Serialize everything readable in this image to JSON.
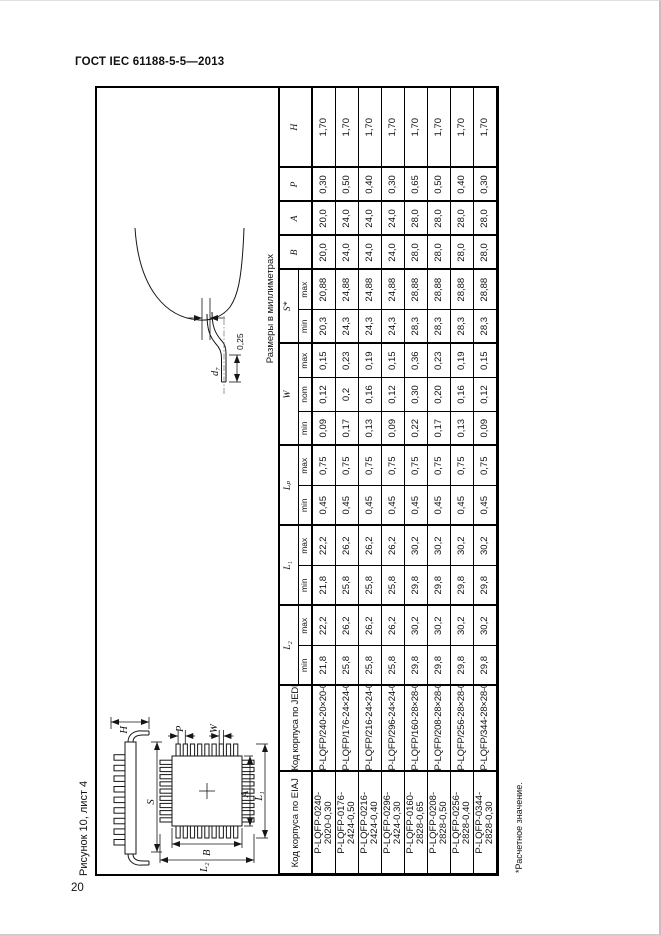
{
  "page": {
    "doc_header": "ГОСТ IEC 61188-5-5—2013",
    "page_number": "20",
    "figure_caption": "Рисунок 10, лист 4",
    "units_note": "Размеры в миллиметрах",
    "footnote": "*Расчетное значение."
  },
  "figure": {
    "labels": {
      "h": "H",
      "s": "S",
      "p": "P",
      "w": "W",
      "a": "A",
      "l1": "L₁",
      "b": "B",
      "l2": "L₂",
      "d7": "d₇",
      "gauge": "0,25"
    }
  },
  "table": {
    "headers": {
      "eiaj": "Код корпуса по EIAJ",
      "jedec": "Код корпуса по JEDEC",
      "l2": "L₂",
      "l1": "L₁",
      "lp": "Lₚ",
      "w": "W",
      "s": "S*",
      "b": "B",
      "a": "A",
      "p": "P",
      "h": "H",
      "min": "min",
      "max": "max",
      "nom": "nom"
    },
    "rows": [
      {
        "eiaj1": "P-LQFP-0240-",
        "eiaj2": "2020-0,30",
        "jedec": "P-LQFP/240-20×20-0,30",
        "l2_min": "21,8",
        "l2_max": "22,2",
        "l1_min": "21,8",
        "l1_max": "22,2",
        "lp_min": "0,45",
        "lp_max": "0,75",
        "w_min": "0,09",
        "w_nom": "0,12",
        "w_max": "0,15",
        "s_min": "20,3",
        "s_max": "20,88",
        "b": "20,0",
        "a": "20,0",
        "p": "0,30",
        "h": "1,70"
      },
      {
        "eiaj1": "P-LQFP-0176-",
        "eiaj2": "2424-0,50",
        "jedec": "P-LQFP/176-24×24-0,50",
        "l2_min": "25,8",
        "l2_max": "26,2",
        "l1_min": "25,8",
        "l1_max": "26,2",
        "lp_min": "0,45",
        "lp_max": "0,75",
        "w_min": "0,17",
        "w_nom": "0,2",
        "w_max": "0,23",
        "s_min": "24,3",
        "s_max": "24,88",
        "b": "24,0",
        "a": "24,0",
        "p": "0,50",
        "h": "1,70"
      },
      {
        "eiaj1": "P-LQFP-0216-",
        "eiaj2": "2424-0,40",
        "jedec": "P-LQFP/216-24×24-0,40",
        "l2_min": "25,8",
        "l2_max": "26,2",
        "l1_min": "25,8",
        "l1_max": "26,2",
        "lp_min": "0,45",
        "lp_max": "0,75",
        "w_min": "0,13",
        "w_nom": "0,16",
        "w_max": "0,19",
        "s_min": "24,3",
        "s_max": "24,88",
        "b": "24,0",
        "a": "24,0",
        "p": "0,40",
        "h": "1,70"
      },
      {
        "eiaj1": "P-LQFP-0296-",
        "eiaj2": "2424-0,30",
        "jedec": "P-LQFP/296-24×24-0,30",
        "l2_min": "25,8",
        "l2_max": "26,2",
        "l1_min": "25,8",
        "l1_max": "26,2",
        "lp_min": "0,45",
        "lp_max": "0,75",
        "w_min": "0,09",
        "w_nom": "0,12",
        "w_max": "0,15",
        "s_min": "24,3",
        "s_max": "24,88",
        "b": "24,0",
        "a": "24,0",
        "p": "0,30",
        "h": "1,70"
      },
      {
        "eiaj1": "P-LQFP-0160-",
        "eiaj2": "2828-0,65",
        "jedec": "P-LQFP/160-28×28-0,65",
        "l2_min": "29,8",
        "l2_max": "30,2",
        "l1_min": "29,8",
        "l1_max": "30,2",
        "lp_min": "0,45",
        "lp_max": "0,75",
        "w_min": "0,22",
        "w_nom": "0,30",
        "w_max": "0,36",
        "s_min": "28,3",
        "s_max": "28,88",
        "b": "28,0",
        "a": "28,0",
        "p": "0,65",
        "h": "1,70"
      },
      {
        "eiaj1": "P-LQFP-0208-",
        "eiaj2": "2828-0,50",
        "jedec": "P-LQFP/208-28×28-0,50",
        "l2_min": "29,8",
        "l2_max": "30,2",
        "l1_min": "29,8",
        "l1_max": "30,2",
        "lp_min": "0,45",
        "lp_max": "0,75",
        "w_min": "0,17",
        "w_nom": "0,20",
        "w_max": "0,23",
        "s_min": "28,3",
        "s_max": "28,88",
        "b": "28,0",
        "a": "28,0",
        "p": "0,50",
        "h": "1,70"
      },
      {
        "eiaj1": "P-LQFP-0256-",
        "eiaj2": "2828-0,40",
        "jedec": "P-LQFP/256-28×28-0,40",
        "l2_min": "29,8",
        "l2_max": "30,2",
        "l1_min": "29,8",
        "l1_max": "30,2",
        "lp_min": "0,45",
        "lp_max": "0,75",
        "w_min": "0,13",
        "w_nom": "0,16",
        "w_max": "0,19",
        "s_min": "28,3",
        "s_max": "28,88",
        "b": "28,0",
        "a": "28,0",
        "p": "0,40",
        "h": "1,70"
      },
      {
        "eiaj1": "P-LQFP-0344-",
        "eiaj2": "2828-0,30",
        "jedec": "P-LQFP/344-28×28-0,30",
        "l2_min": "29,8",
        "l2_max": "30,2",
        "l1_min": "29,8",
        "l1_max": "30,2",
        "lp_min": "0,45",
        "lp_max": "0,75",
        "w_min": "0,09",
        "w_nom": "0,12",
        "w_max": "0,15",
        "s_min": "28,3",
        "s_max": "28,88",
        "b": "28,0",
        "a": "28,0",
        "p": "0,30",
        "h": "1,70"
      }
    ]
  }
}
